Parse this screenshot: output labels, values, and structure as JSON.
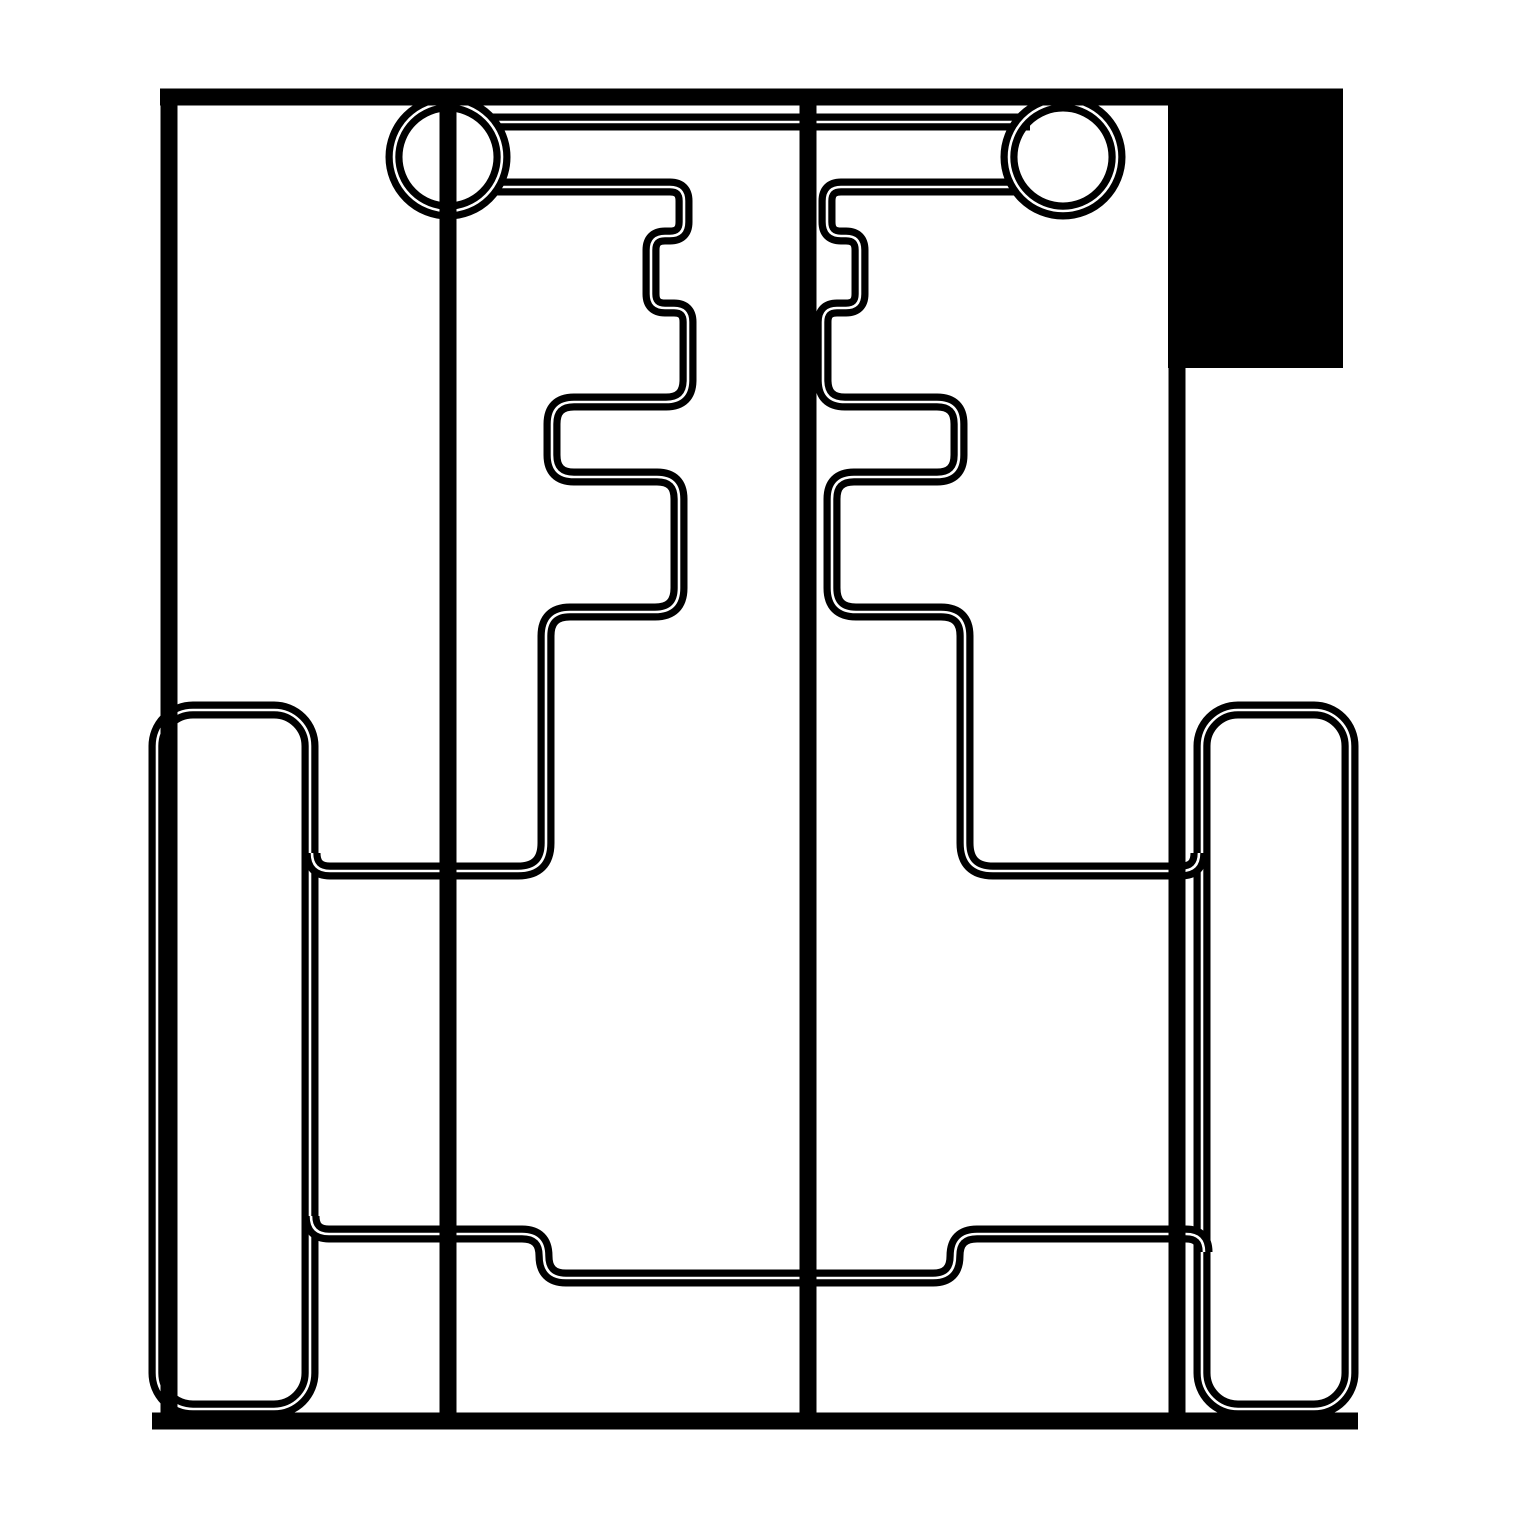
{
  "canvas": {
    "width": 1519,
    "height": 1519,
    "background_color": "#ffffff",
    "ink_color": "#000000",
    "seam_color": "#ffffff"
  },
  "styles": {
    "single_line_width": 17,
    "band_width": 17,
    "seam_width": 2.6
  },
  "drawing": {
    "description": "monochrome technical cut-plan line drawing",
    "shapes": [
      {
        "name": "left-wheel-outline",
        "kind": "rect",
        "style": "band",
        "x": 157,
        "y": 710,
        "w": 153,
        "h": 699,
        "rx": 36
      },
      {
        "name": "right-wheel-outline",
        "kind": "rect",
        "style": "band",
        "x": 1202,
        "y": 710,
        "w": 148,
        "h": 699,
        "rx": 36
      },
      {
        "name": "bottom-rail-path",
        "kind": "path",
        "style": "band",
        "d": "M 311 1216 Q 311 1234 329 1234 L 522 1234 Q 544 1234 544 1256 Q 544 1278 566 1278 L 933 1278 Q 955 1278 955 1256 Q 955 1234 977 1234 L 1186 1234 Q 1204 1234 1204 1252"
      },
      {
        "name": "left-comb-path",
        "kind": "path",
        "style": "band",
        "d": "M 492 187 L 670 187 Q 684 187 684 201 L 684 222 Q 684 236 670 236 L 665 236 Q 651 236 651 250 L 651 294 Q 651 308 665 308 L 674 308 Q 688 308 688 322 L 688 380 Q 688 402 666 402 L 574 402 Q 552 402 552 424 L 552 455 Q 552 477 574 477 L 657 477 Q 679 477 679 499 L 679 588 Q 679 612 655 612 L 570 612 Q 546 612 546 636 L 546 843 Q 546 871 518 871 L 330 871 Q 312 871 312 853"
      },
      {
        "name": "right-comb-path",
        "kind": "path",
        "style": "band",
        "d": "M 1019 187 L 841 187 Q 827 187 827 201 L 827 222 Q 827 236 841 236 L 846 236 Q 860 236 860 250 L 860 294 Q 860 308 846 308 L 837 308 Q 823 308 823 322 L 823 380 Q 823 402 845 402 L 937 402 Q 959 402 959 424 L 959 455 Q 959 477 937 477 L 854 477 Q 832 477 832 499 L 832 588 Q 832 612 856 612 L 941 612 Q 965 612 965 636 L 965 843 Q 965 871 993 871 L 1181 871 Q 1199 871 1199 853"
      },
      {
        "name": "axle-bar-top",
        "kind": "line",
        "style": "band",
        "x1": 490,
        "y1": 122,
        "x2": 1030,
        "y2": 122
      },
      {
        "name": "left-hub-circle",
        "kind": "circle",
        "style": "band",
        "cx": 448,
        "cy": 157,
        "r": 54
      },
      {
        "name": "right-hub-circle",
        "kind": "circle",
        "style": "band",
        "cx": 1063,
        "cy": 157,
        "r": 54
      },
      {
        "name": "outer-top-edge",
        "kind": "line",
        "style": "line",
        "x1": 160,
        "y1": 97,
        "x2": 1343,
        "y2": 97
      },
      {
        "name": "outer-left-edge",
        "kind": "line",
        "style": "line",
        "x1": 169,
        "y1": 97,
        "x2": 169,
        "y2": 1421
      },
      {
        "name": "outer-right-edge",
        "kind": "line",
        "style": "line",
        "x1": 1177,
        "y1": 97,
        "x2": 1177,
        "y2": 1421
      },
      {
        "name": "outer-bottom-edge",
        "kind": "line",
        "style": "line",
        "x1": 152,
        "y1": 1421,
        "x2": 1358,
        "y2": 1421
      },
      {
        "name": "left-divider-line",
        "kind": "line",
        "style": "line",
        "x1": 448,
        "y1": 97,
        "x2": 448,
        "y2": 1421
      },
      {
        "name": "center-divider-line",
        "kind": "line",
        "style": "line",
        "x1": 808,
        "y1": 97,
        "x2": 808,
        "y2": 1421
      },
      {
        "name": "corner-solid-rect",
        "kind": "rect",
        "style": "fill",
        "x": 1168,
        "y": 89,
        "w": 175,
        "h": 279,
        "rx": 0
      }
    ]
  }
}
